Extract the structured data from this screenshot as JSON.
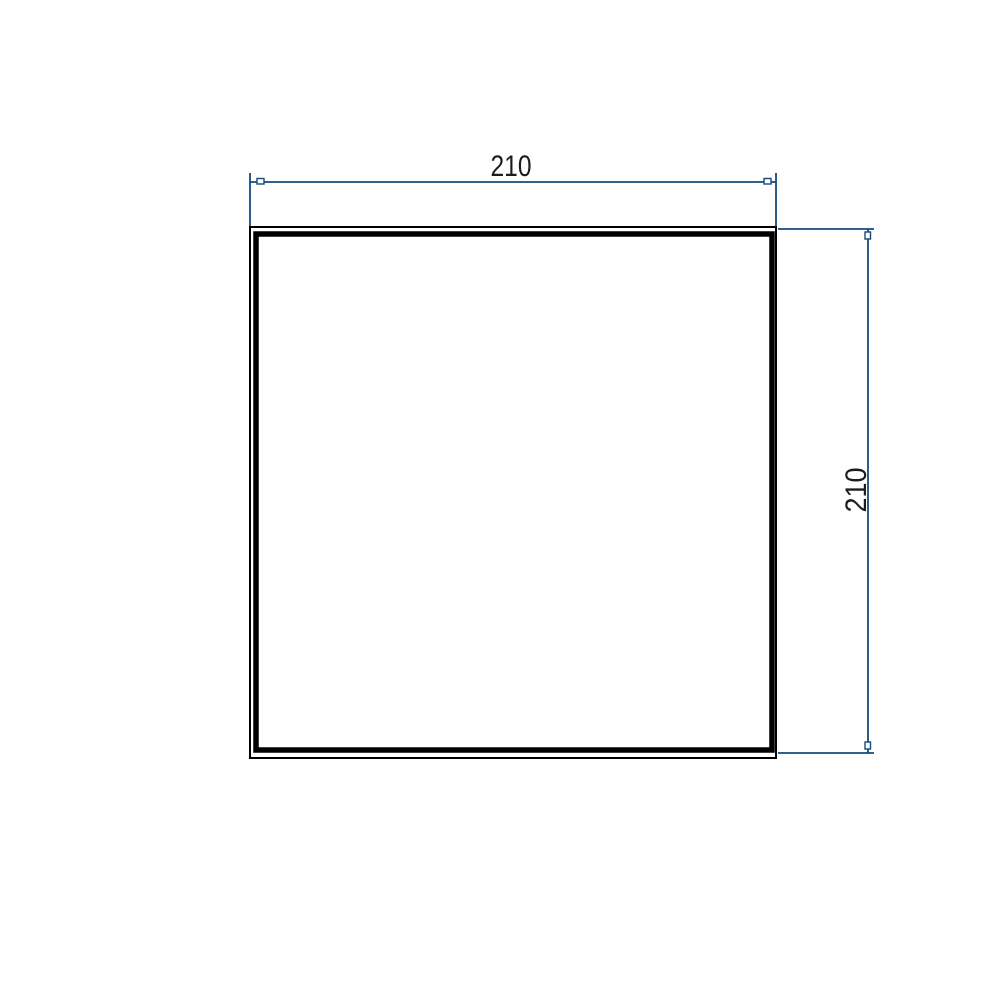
{
  "drawing": {
    "dimensions": {
      "horizontal": {
        "value": "210",
        "position": "top"
      },
      "vertical": {
        "value": "210",
        "position": "right"
      }
    },
    "colors": {
      "dimension": "#154A7D",
      "contour": "#000000",
      "label": "#1C1C1C",
      "background": "#FFFFFF"
    }
  }
}
